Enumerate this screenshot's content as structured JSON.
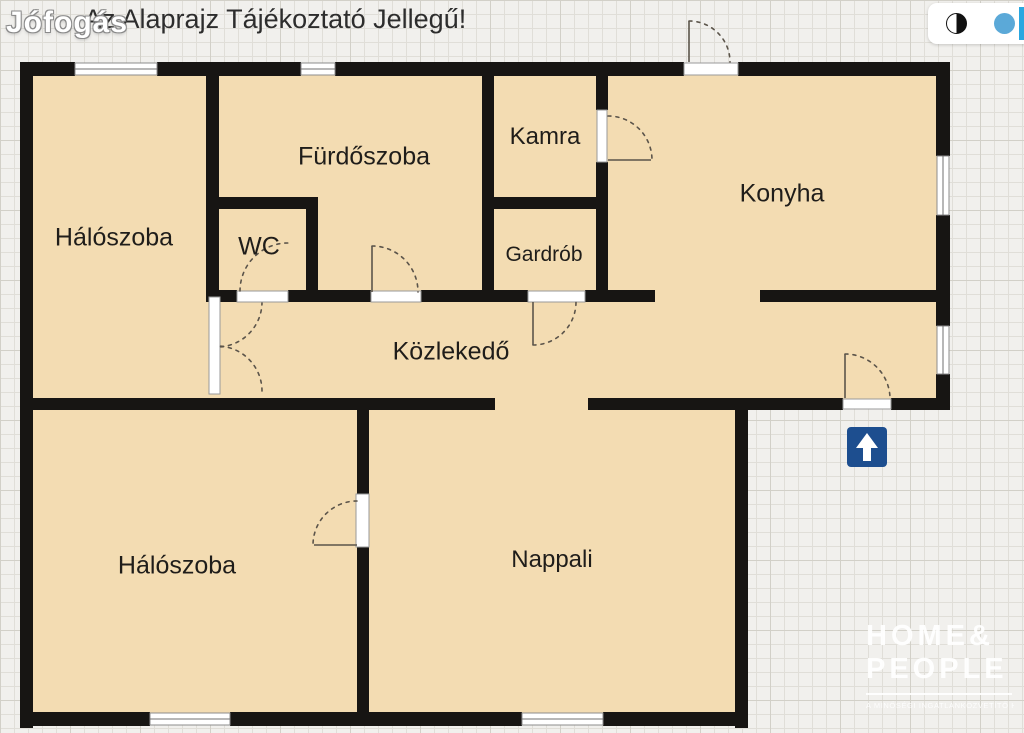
{
  "header": {
    "title": "Az Alaprajz Tájékoztató Jellegű!"
  },
  "watermark": {
    "brand": "Jófogás"
  },
  "toolbar": {
    "icons": [
      "contrast-circle",
      "blue-circle",
      "blue-edge-bar"
    ]
  },
  "rooms": {
    "bedroom_top": "Hálószoba",
    "bathroom": "Fürdőszoba",
    "pantry": "Kamra",
    "kitchen": "Konyha",
    "wc": "WC",
    "wardrobe": "Gardrób",
    "hallway": "Közlekedő",
    "bedroom_bottom": "Hálószoba",
    "living_room": "Nappali"
  },
  "agency_logo": {
    "line1": "HOME&",
    "line2": "PEOPLE",
    "tagline": "A MINŐSÉGI INGATLANKÖZVETÍTŐ HÁLÓZAT"
  },
  "entrance": {
    "symbol": "up-arrow"
  },
  "colors": {
    "floor": "#f3dcb2",
    "wall": "#171513",
    "bg": "#f1f0ed",
    "grid-line": "#e0ded8",
    "grid-strong": "#d2d0c8",
    "arrow-blue": "#1d4e8f",
    "toolbar-blue": "#5ba9d8",
    "toolbar-bar": "#2aa7e0",
    "label": "#1f1d1a",
    "arc": "#5b544a",
    "window-frame": "#8c8c8c"
  }
}
